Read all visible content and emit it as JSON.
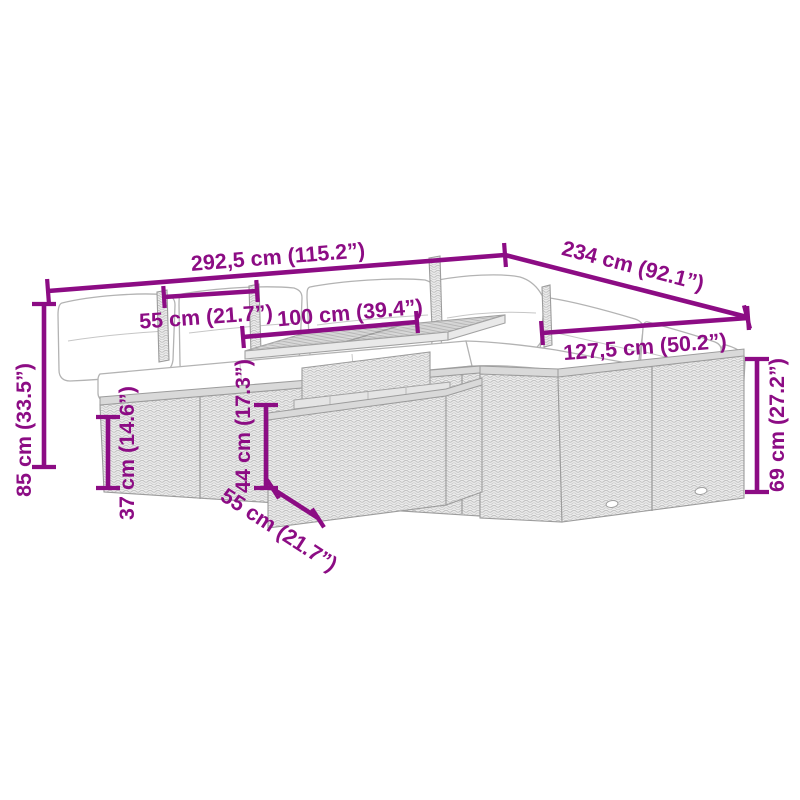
{
  "page": {
    "background": "#ffffff"
  },
  "style": {
    "accent_color": "#8C0C84",
    "furniture_line_color": "#a2a2a2",
    "wicker_fill_color": "#ebebeb",
    "cushion_color": "#ffffff"
  },
  "diagram": {
    "type": "product-dimension-diagram",
    "subject": "poly rattan garden corner sofa set with cushions and lift-top table",
    "dimensions": {
      "overall_width": "292,5 cm (115.2”)",
      "overall_depth": "234 cm (92.1”)",
      "seat_width": "55 cm (21.7”)",
      "table_width": "100 cm (39.4”)",
      "right_section_width": "127,5 cm (50.2”)",
      "overall_height": "85 cm (33.5”)",
      "seat_height": "37 cm (14.6”)",
      "table_height": "44 cm (17.3”)",
      "back_height": "69 cm (27.2”)",
      "table_depth": "55 cm (21.7”)"
    }
  }
}
